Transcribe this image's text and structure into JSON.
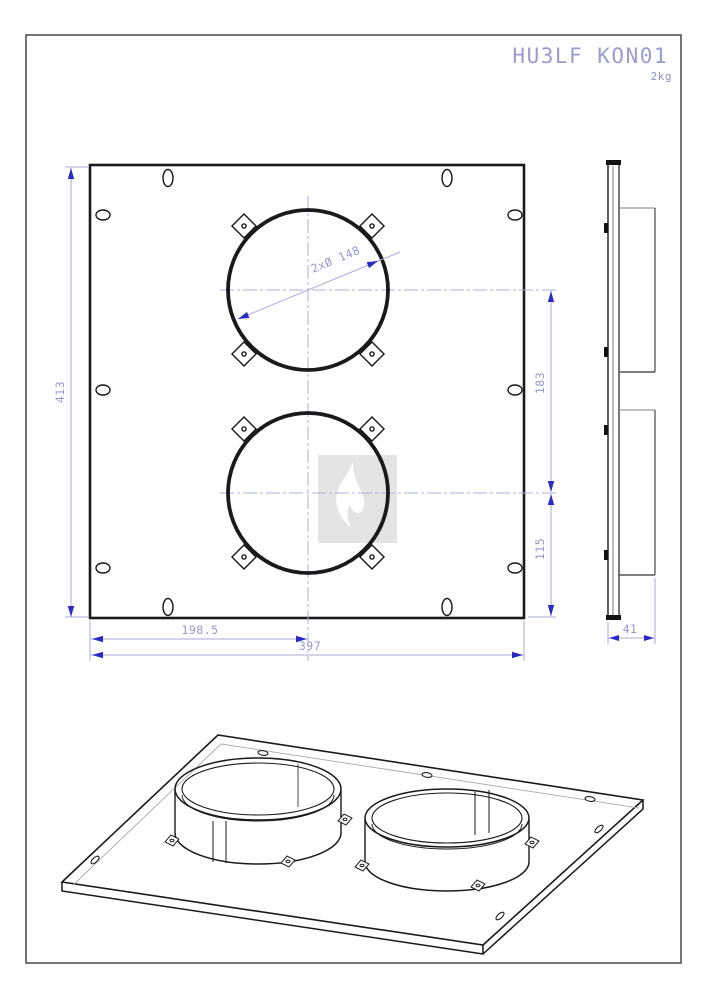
{
  "title_block": {
    "title": "HU3LF KON01",
    "weight": "2kg"
  },
  "dimensions": {
    "overall_height": "413",
    "overall_width": "397",
    "center_x": "198.5",
    "hole_spacing": "183",
    "bottom_offset": "115",
    "depth": "41",
    "hole_dia": "2xØ 148"
  },
  "views": {
    "front_view": "plate with two circular collar openings, eight corner clip tabs and edge mounting slots",
    "side_view": "plate profile with two protruding collars",
    "isometric_view": "3D view of plate with two round collars"
  },
  "watermark": {
    "icon": "flame-icon"
  },
  "colors": {
    "line": "#1a1a1a",
    "dimension_line": "#a9a9da",
    "dimension_text": "#9898cc",
    "arrow": "#2a2ac8",
    "centerline": "#aab0dd",
    "title_text": "#9b9bd0",
    "frame": "#3a3a3a",
    "watermark_bg": "#e4e4e4",
    "watermark_flame": "#ffffff"
  }
}
